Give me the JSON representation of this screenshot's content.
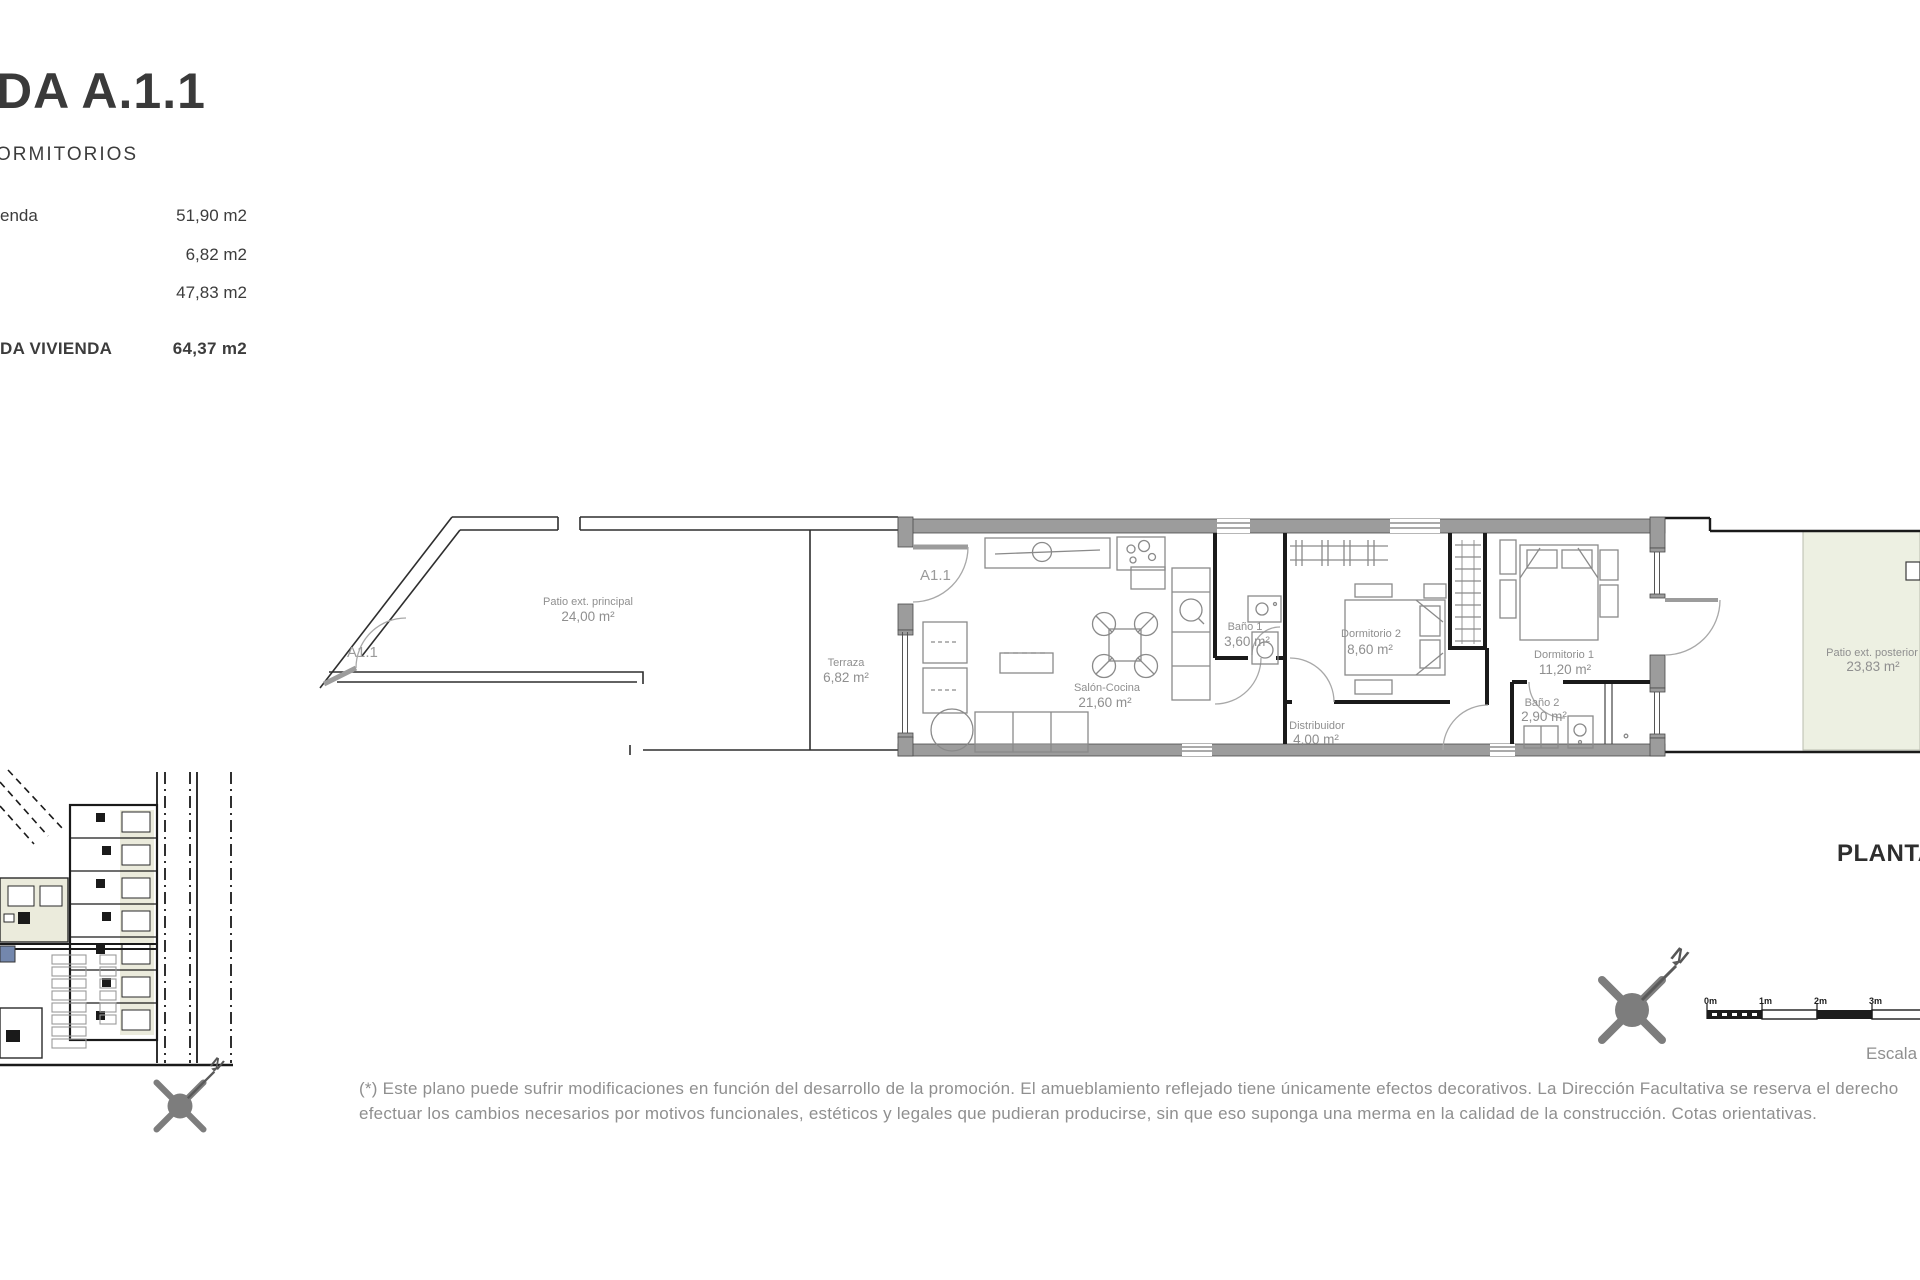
{
  "info_panel": {
    "title": "DA A.1.1",
    "subtitle": "ORMITORIOS",
    "rows": [
      {
        "label": "enda",
        "value": "51,90 m2"
      },
      {
        "label": "",
        "value": "6,82 m2"
      },
      {
        "label": "",
        "value": "47,83 m2"
      }
    ],
    "total_row": {
      "label": "DA VIVIENDA",
      "value": "64,37 m2"
    }
  },
  "plan": {
    "tags": {
      "patio": "A1.1",
      "entry": "A1.1"
    },
    "rooms": {
      "patio_principal": {
        "name": "Patio ext. principal",
        "area": "24,00 m²"
      },
      "terraza": {
        "name": "Terraza",
        "area": "6,82 m²"
      },
      "salon": {
        "name": "Salón-Cocina",
        "area": "21,60 m²"
      },
      "bano1": {
        "name": "Baño 1",
        "area": "3,60 m²"
      },
      "dormitorio2": {
        "name": "Dormitorio 2",
        "area": "8,60 m²"
      },
      "distribuidor": {
        "name": "Distribuidor",
        "area": "4,00 m²"
      },
      "dormitorio1": {
        "name": "Dormitorio 1",
        "area": "11,20 m²"
      },
      "bano2": {
        "name": "Baño 2",
        "area": "2,90 m²"
      },
      "patio_posterior": {
        "name": "Patio ext. posterior",
        "area": "23,83 m²"
      }
    }
  },
  "annotations": {
    "plan_title": "PLANTA",
    "scale_label": "Escala",
    "north_letter": "N",
    "scale_ticks": [
      "0m",
      "1m",
      "2m",
      "3m"
    ]
  },
  "disclaimer": {
    "line1": "(*) Este plano puede sufrir modificaciones en función del desarrollo de la promoción. El amueblamiento reflejado tiene únicamente efectos decorativos. La Dirección Facultativa se reserva el derecho",
    "line2": "efectuar los cambios necesarios por motivos funcionales, estéticos y legales que pudieran producirse, sin que eso suponga una merma en la calidad de la construcción. Cotas orientativas."
  },
  "colors": {
    "wall_gray": "#9c9c9c",
    "partition_black": "#1a1a1a",
    "patio_green": "#edf0e2",
    "highlight_blue": "#7387ad",
    "text_dark": "#3c3c3c",
    "text_gray": "#8f8f8f"
  }
}
